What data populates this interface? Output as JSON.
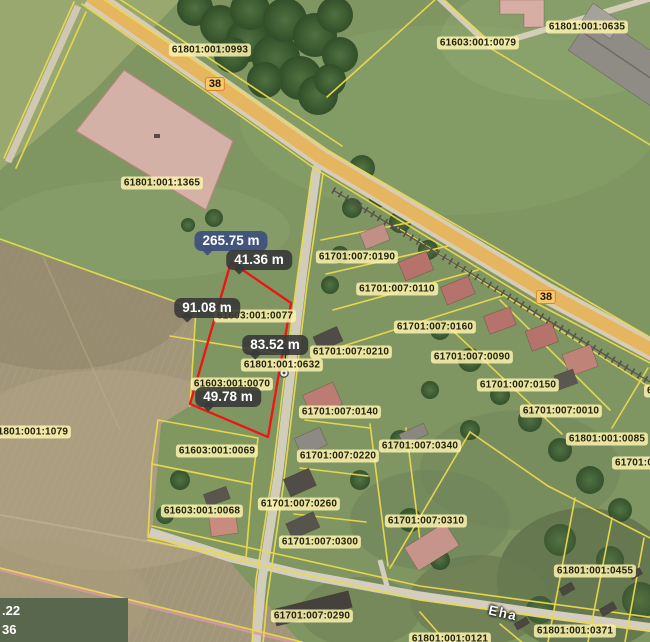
{
  "map": {
    "road_number_badges": [
      {
        "label": "38"
      },
      {
        "label": "38"
      }
    ],
    "street_name_label": "Eha",
    "cadastral_labels": [
      {
        "code": "61801:001:0993"
      },
      {
        "code": "61603:001:0079"
      },
      {
        "code": "61801:001:0635"
      },
      {
        "code": "61801:001:1365"
      },
      {
        "code": "61701:007:0190"
      },
      {
        "code": "61701:007:0110"
      },
      {
        "code": "61701:007:0160"
      },
      {
        "code": "61701:007:0210"
      },
      {
        "code": "61701:007:0090"
      },
      {
        "code": "61701:007:0150"
      },
      {
        "code": "61701:007:0010"
      },
      {
        "code": "61801:001:0085"
      },
      {
        "code": "61701:007:0140"
      },
      {
        "code": "61701:007:0220"
      },
      {
        "code": "61701:007:0340"
      },
      {
        "code": "61701:007:0260"
      },
      {
        "code": "61701:007:0310"
      },
      {
        "code": "61701:007:0300"
      },
      {
        "code": "61701:007:0290"
      },
      {
        "code": "61801:001:0455"
      },
      {
        "code": "61801:001:0371"
      },
      {
        "code": "61801:001:0121"
      },
      {
        "code": "61603:001:0069"
      },
      {
        "code": "61603:001:0068"
      },
      {
        "code": "61801:001:1079"
      },
      {
        "code": "61603:001:0077"
      },
      {
        "code": "61801:001:0632"
      },
      {
        "code": "61603:001:0070"
      },
      {
        "code": "61701:00"
      },
      {
        "code": "6"
      }
    ],
    "measurement_tool": {
      "total_length_label": "265.75 m",
      "segment_length_labels": [
        {
          "label": "41.36 m"
        },
        {
          "label": "91.08 m"
        },
        {
          "label": "83.52 m"
        },
        {
          "label": "49.78 m"
        }
      ]
    },
    "bottom_left_readout": {
      "line1": ".22",
      "line2": "36"
    },
    "icons": [
      {
        "name": "signpost-icon"
      },
      {
        "name": "survey-marker-icon"
      }
    ],
    "colors": {
      "parcel_boundary_line": "#ecd94d",
      "selected_parcel_outline": "#f11212",
      "measurement_badge_bg": "#383838",
      "total_measurement_badge_bg": "#40507f",
      "cadastral_label_bg": "#fbf2ae",
      "road_badge_bg": "#f7c76b",
      "road_badge_border": "#d8872a"
    }
  }
}
